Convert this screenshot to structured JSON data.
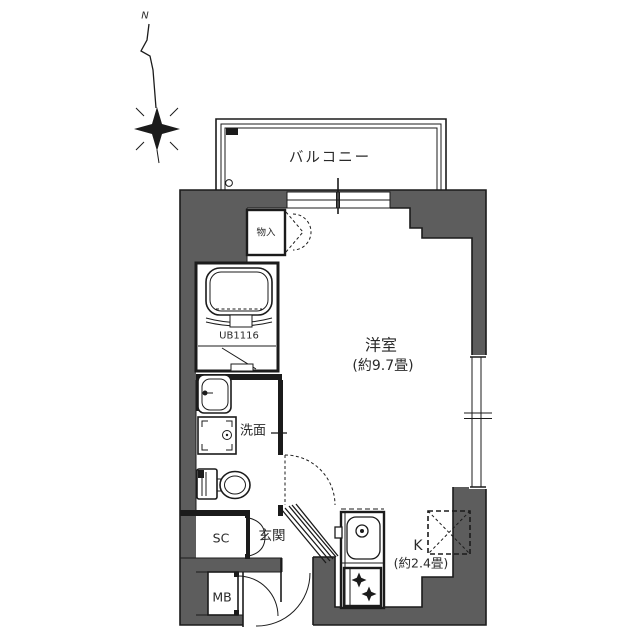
{
  "title": "マンション間取り図 (apartment floor plan)",
  "colors": {
    "wall": "#5d5d5d",
    "line": "#1b1b1b",
    "text": "#2a2a2a",
    "bg": "#ffffff"
  },
  "compass": {
    "label": "N"
  },
  "rooms": {
    "balcony": {
      "label": "バルコニー"
    },
    "living": {
      "label": "洋室",
      "size": "(約9.7畳)"
    },
    "kitchen": {
      "label": "K",
      "size": "(約2.4畳)"
    },
    "washroom": {
      "label": "洗面"
    },
    "bath": {
      "label": "UB1116"
    },
    "storage": {
      "label": "物入"
    },
    "entrance": {
      "label": "玄関"
    },
    "shoe_closet": {
      "label": "SC"
    },
    "meter_box": {
      "label": "MB"
    }
  }
}
